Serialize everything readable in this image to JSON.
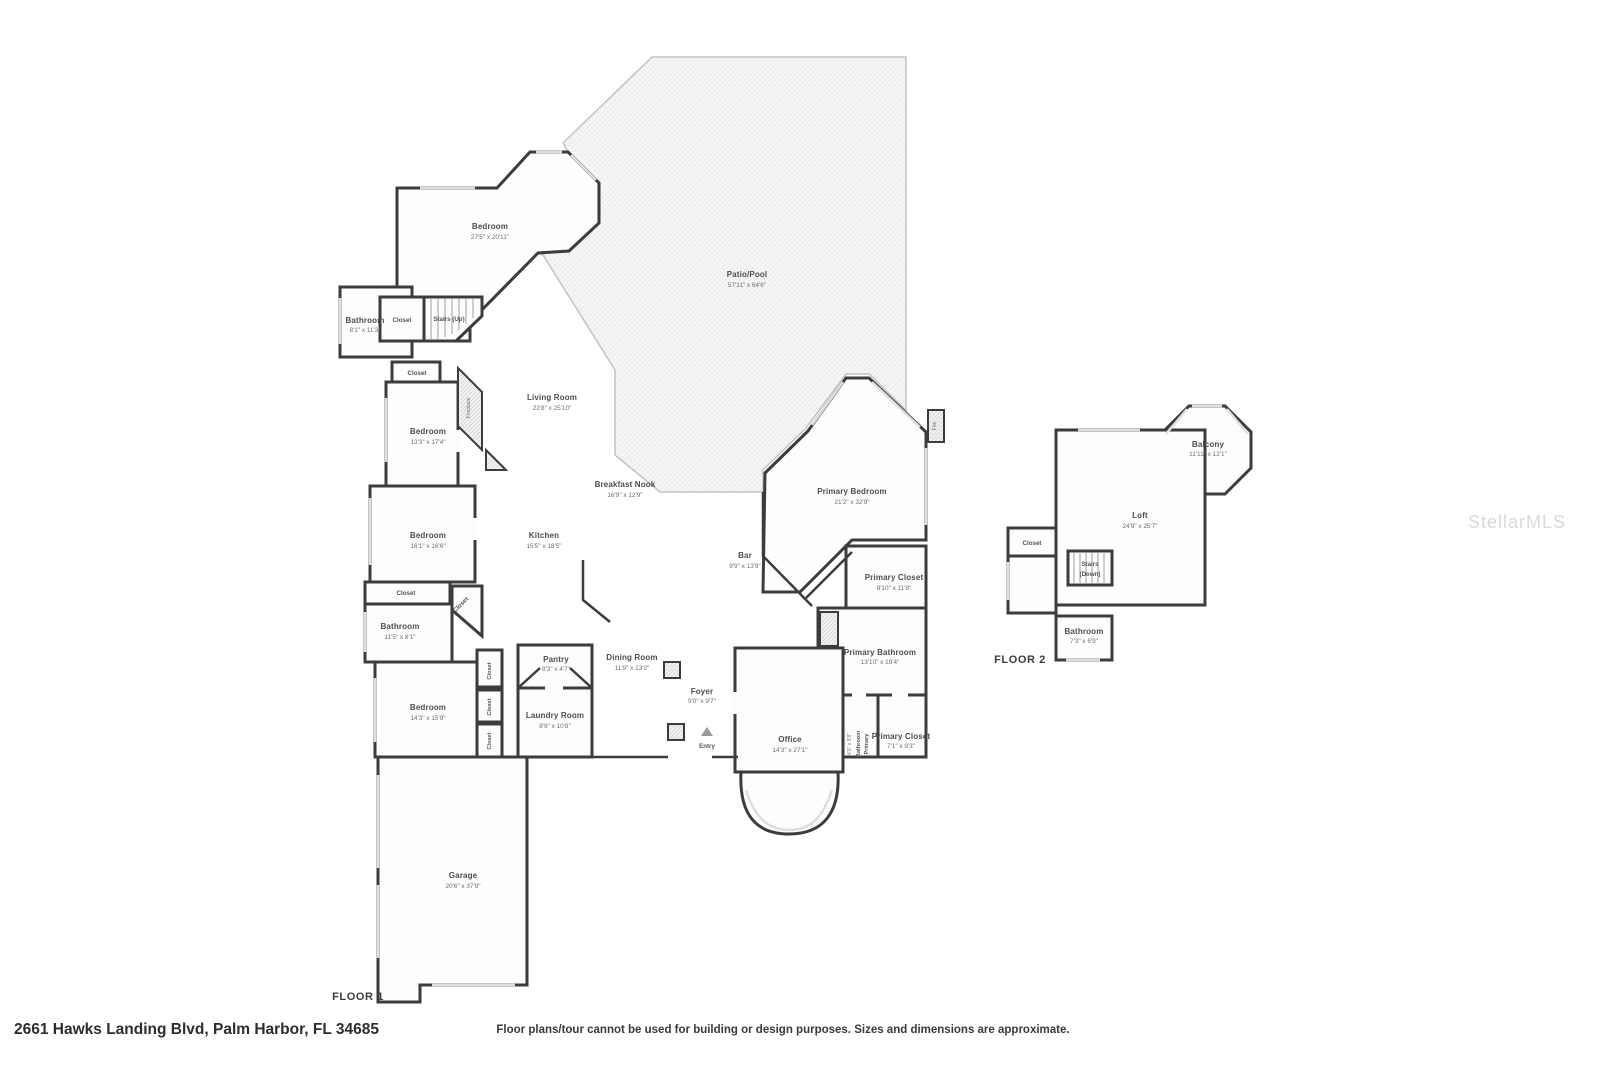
{
  "page": {
    "address": "2661 Hawks Landing Blvd, Palm Harbor, FL 34685",
    "disclaimer": "Floor plans/tour cannot be used for building or design purposes. Sizes and dimensions are approximate.",
    "watermark": "StellarMLS",
    "wall_color": "#3c3c3c",
    "accent_gray": "#dedede"
  },
  "floor1": {
    "label": "FLOOR 1",
    "rooms": {
      "bedroom_top": {
        "name": "Bedroom",
        "dims": "27'5\" x 20'11\""
      },
      "bathroom_top": {
        "name": "Bathroom",
        "dims": "8'1\" x 11'3\""
      },
      "closet_a": {
        "name": "Closet"
      },
      "stairs_up": {
        "name": "Stairs (Up)"
      },
      "closet_b": {
        "name": "Closet"
      },
      "fireplace": {
        "name": "Fireplace"
      },
      "living_room": {
        "name": "Living Room",
        "dims": "22'8\" x 25'10\""
      },
      "patio": {
        "name": "Patio/Pool",
        "dims": "57'11\" x 64'6\""
      },
      "bedroom_2": {
        "name": "Bedroom",
        "dims": "13'3\" x 17'4\""
      },
      "breakfast_nook": {
        "name": "Breakfast Nook",
        "dims": "16'9\" x 12'9\""
      },
      "bedroom_3": {
        "name": "Bedroom",
        "dims": "16'1\" x 16'6\""
      },
      "kitchen": {
        "name": "Kitchen",
        "dims": "15'5\" x 18'5\""
      },
      "primary_bedroom": {
        "name": "Primary Bedroom",
        "dims": "21'2\" x 32'9\""
      },
      "bar": {
        "name": "Bar",
        "dims": "9'9\" x 13'9\""
      },
      "fire_feature": {
        "name": "Fire"
      },
      "primary_closet_1": {
        "name": "Primary Closet",
        "dims": "9'10\" x 11'8\""
      },
      "closet_c": {
        "name": "Closet"
      },
      "closet_d": {
        "name": "Closet"
      },
      "bathroom_2": {
        "name": "Bathroom",
        "dims": "11'5\" x 8'1\""
      },
      "closet_e": {
        "name": "Closet"
      },
      "closet_f": {
        "name": "Closet"
      },
      "closet_g": {
        "name": "Closet"
      },
      "pantry": {
        "name": "Pantry",
        "dims": "8'3\" x 4'7\""
      },
      "dining_room": {
        "name": "Dining Room",
        "dims": "11'9\" x 13'2\""
      },
      "foyer": {
        "name": "Foyer",
        "dims": "9'0\" x 9'7\""
      },
      "bedroom_4": {
        "name": "Bedroom",
        "dims": "14'3\" x 15'9\""
      },
      "laundry_room": {
        "name": "Laundry Room",
        "dims": "8'9\" x 10'8\""
      },
      "entry": {
        "name": "Entry"
      },
      "office": {
        "name": "Office",
        "dims": "14'3\" x 27'1\""
      },
      "primary_bathroom": {
        "name": "Primary Bathroom",
        "dims": "13'10\" x 19'4\""
      },
      "primary_bathroom_2": {
        "line1": "Primary",
        "line2": "Bathroom",
        "dims": "4'0\" x 9'8\""
      },
      "primary_closet_2": {
        "name": "Primary Closet",
        "dims": "7'1\" x 9'3\""
      },
      "garage": {
        "name": "Garage",
        "dims": "20'6\" x 37'9\""
      }
    }
  },
  "floor2": {
    "label": "FLOOR 2",
    "rooms": {
      "balcony": {
        "name": "Balcony",
        "dims": "11'11\" x 12'1\""
      },
      "loft": {
        "name": "Loft",
        "dims": "24'9\" x 25'7\""
      },
      "closet": {
        "name": "Closet"
      },
      "stairs_down": {
        "line1": "Stairs",
        "line2": "(Down)"
      },
      "bathroom": {
        "name": "Bathroom",
        "dims": "7'3\" x 6'9\""
      }
    }
  }
}
